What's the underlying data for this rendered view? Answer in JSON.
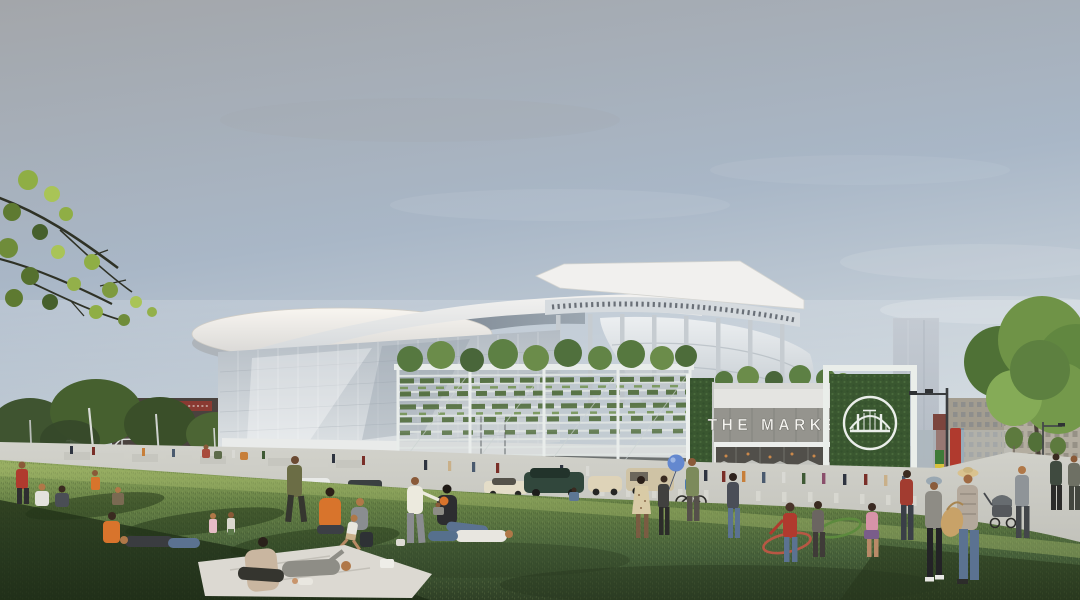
{
  "meta": {
    "type": "architectural-rendering",
    "subject": "waterfront-arena-with-public-lawn"
  },
  "signs": {
    "the_market": "THE MARKET",
    "bay_bar": "BAY FAR"
  },
  "icons": {
    "warriors_logo": "bridge-in-circle-logo"
  },
  "palette": {
    "sky-top": "#a3a6aa",
    "sky-mid": "#a9b7c7",
    "sky-horizon": "#e7eaec",
    "arena-white": "#f3f2f0",
    "arena-shade": "#c9cfd4",
    "bowl-dark": "#5d6874",
    "glass-top": "#b4bcc4",
    "glass-bottom": "#e3e7e9",
    "trellis-frame": "#e9edeb",
    "vine-green": "#4e6b38",
    "living-wall": "#3a5730",
    "logo-white": "#eaeeea",
    "market-wall": "#e4e4e1",
    "sign-glass": "#95948e",
    "sign-text": "#f4f3ef",
    "lawn-light": "#93ab60",
    "lawn-mid": "#647f44",
    "lawn-dark": "#2f4026",
    "pavement": "#c2c2bb",
    "tree-dark": "#3f5430",
    "tree-bright": "#6f9347",
    "accent-red": "#b03a2e",
    "accent-orange": "#d8742c",
    "denim": "#5b7291",
    "balloon-blue": "#6488cf"
  }
}
